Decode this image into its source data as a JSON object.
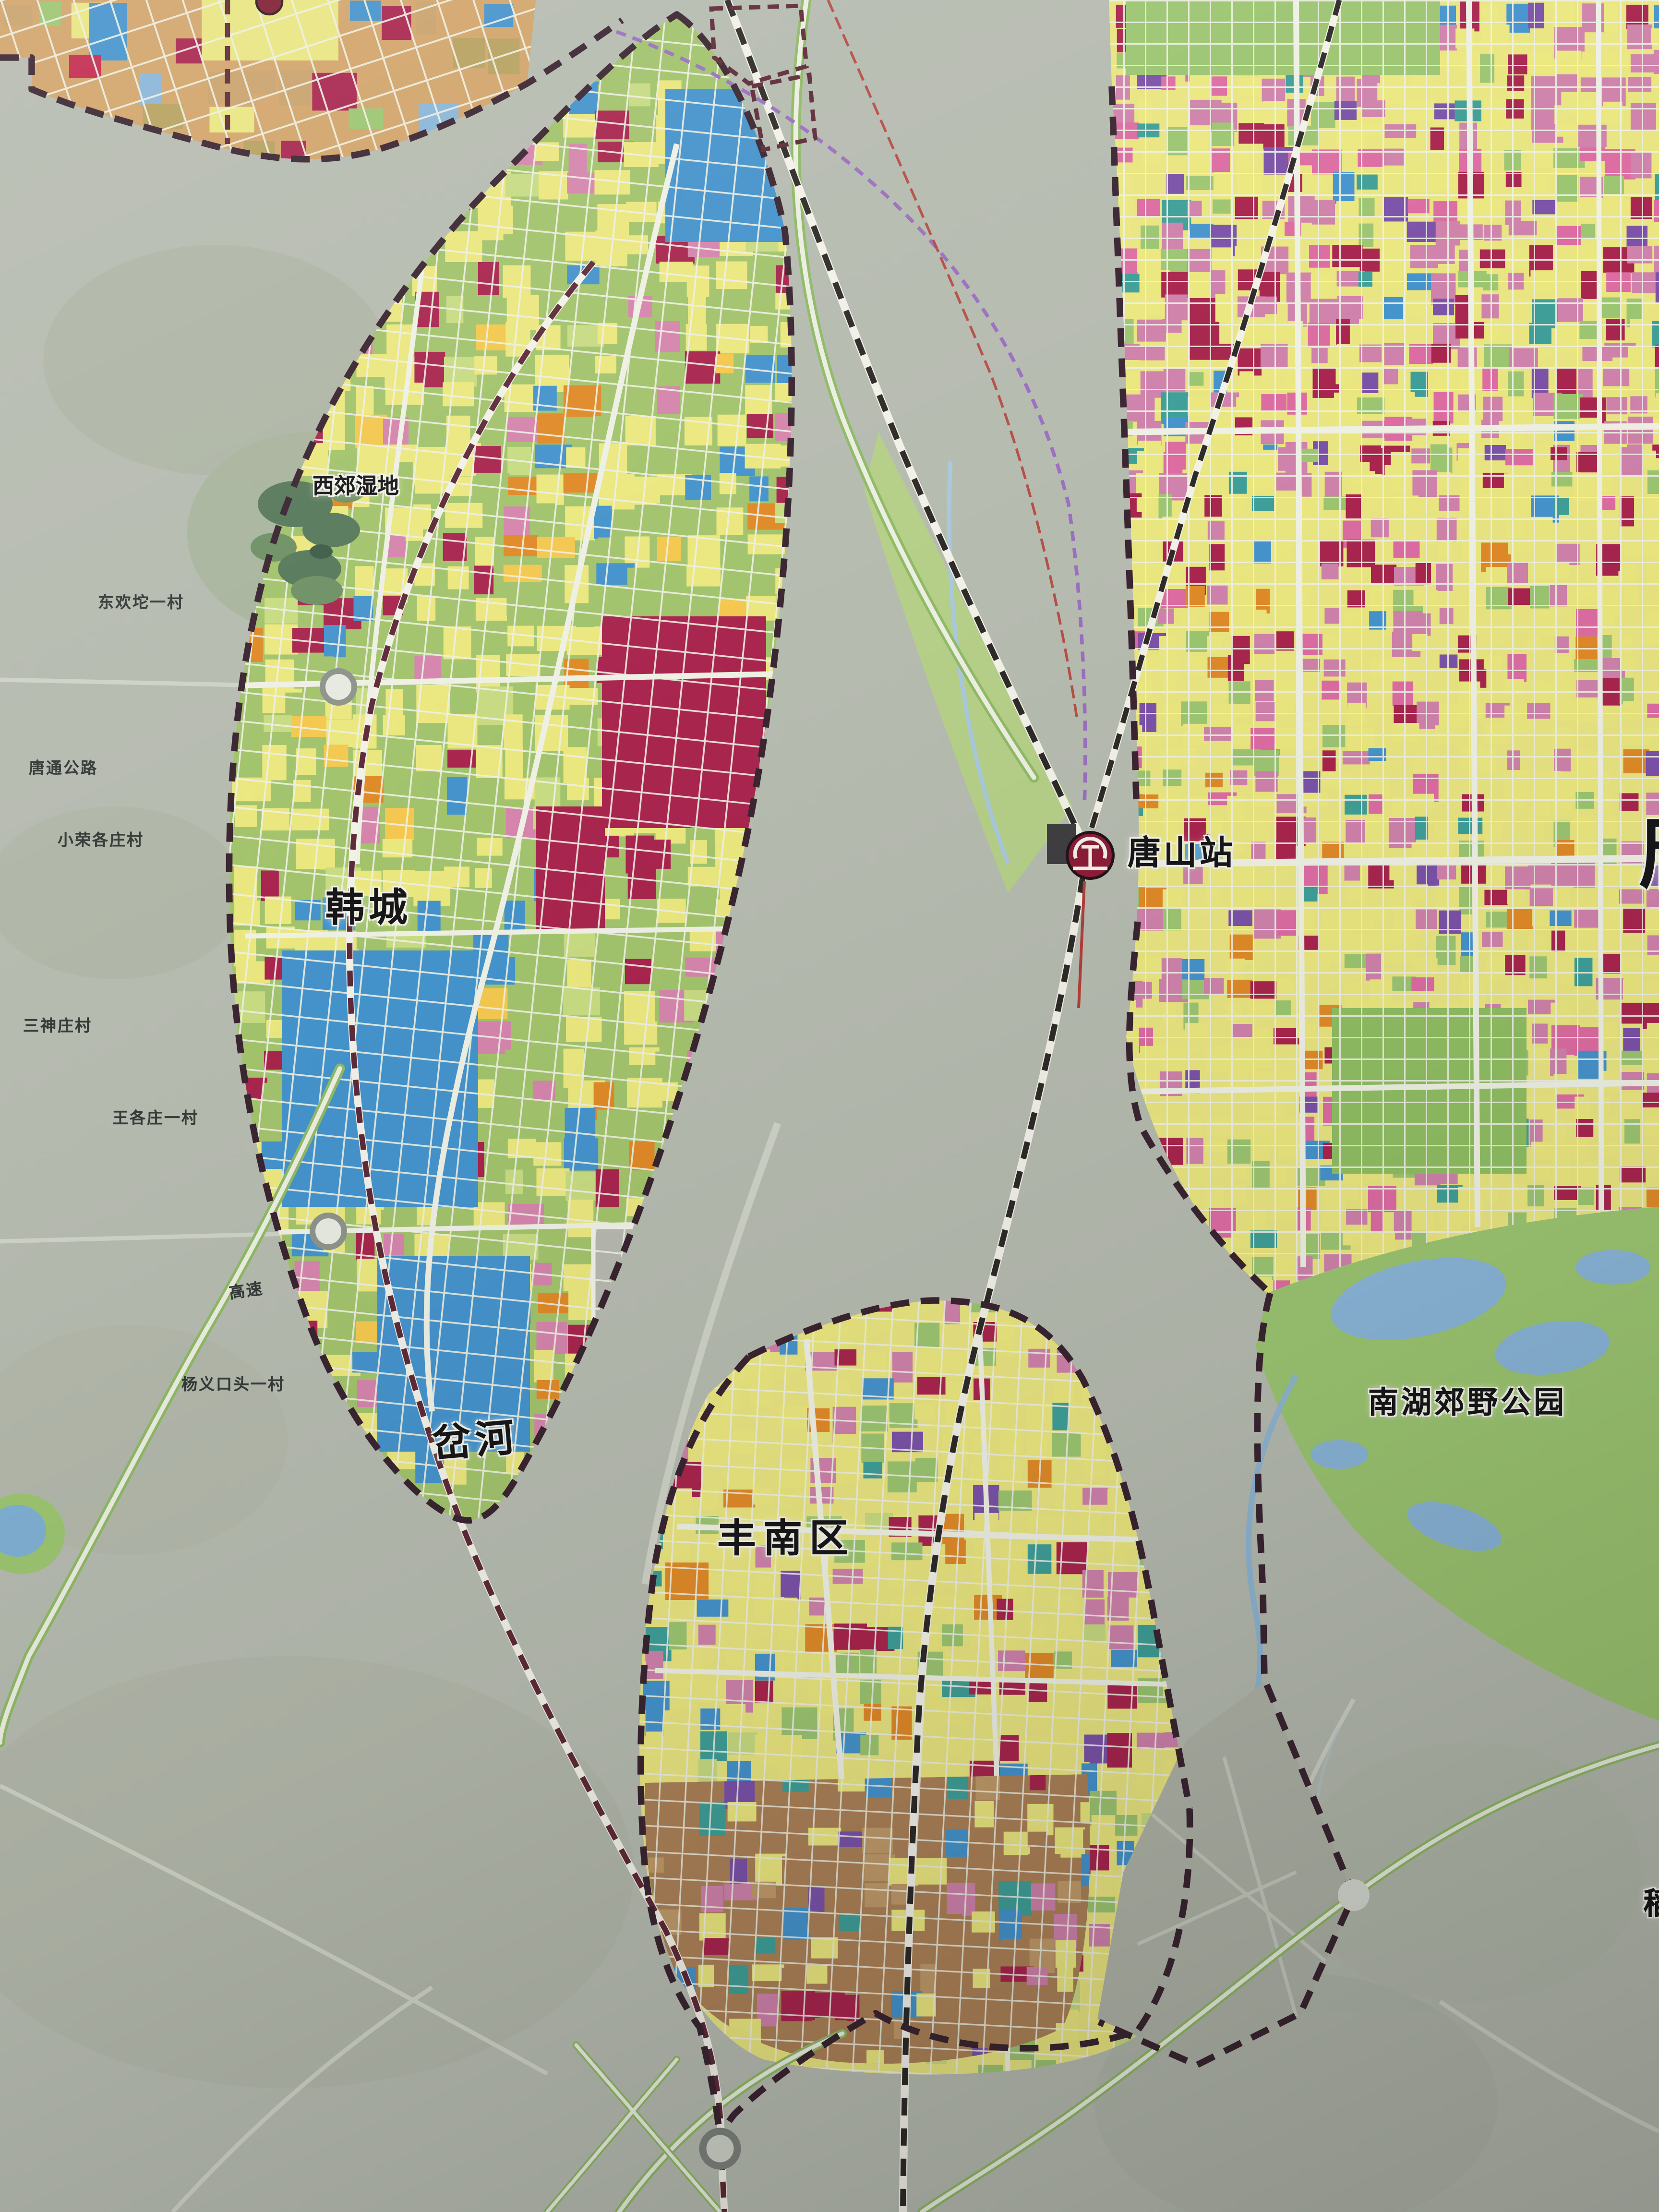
{
  "map": {
    "kind": "urban-master-plan-wall-map-photo",
    "labels": {
      "wetland_xijiao": {
        "text": "西郊湿地"
      },
      "village_donghuantuo": {
        "text": "东欢坨一村"
      },
      "road_tangtong": {
        "text": "唐通公路"
      },
      "village_xiaorong": {
        "text": "小荣各庄村"
      },
      "district_hancheng": {
        "text": "韩城"
      },
      "village_sanshenzhuang": {
        "text": "三神庄村"
      },
      "village_wanggezhuang": {
        "text": "王各庄一村"
      },
      "road_expressway": {
        "text": "高速"
      },
      "village_yangyikoutou": {
        "text": "杨义口头一村"
      },
      "river_chahe": {
        "text": "岔河"
      },
      "station_tangshan": {
        "text": "唐山站"
      },
      "park_nanhu": {
        "text": "南湖郊野公园"
      },
      "district_fengnan": {
        "text": "丰南区"
      },
      "edge_partial_right": {
        "text": "唐"
      },
      "edge_partial_bottom_right": {
        "text": "稻"
      }
    },
    "legend_colors": {
      "residential_yellow": "#ebe77f",
      "public_pink": "#cf82ab",
      "commercial_red": "#a8254e",
      "industrial_blue": "#4593cc",
      "green_space": "#9cc571",
      "village_tan": "#d2a46a",
      "logistics_brown": "#ab8157",
      "water_blue": "#8ab5d8",
      "boundary_dark": "#3a2531",
      "station_red": "#8c1c38",
      "metro_purple": "#9b6fc0",
      "background_gray": "#b6bbb0"
    }
  }
}
